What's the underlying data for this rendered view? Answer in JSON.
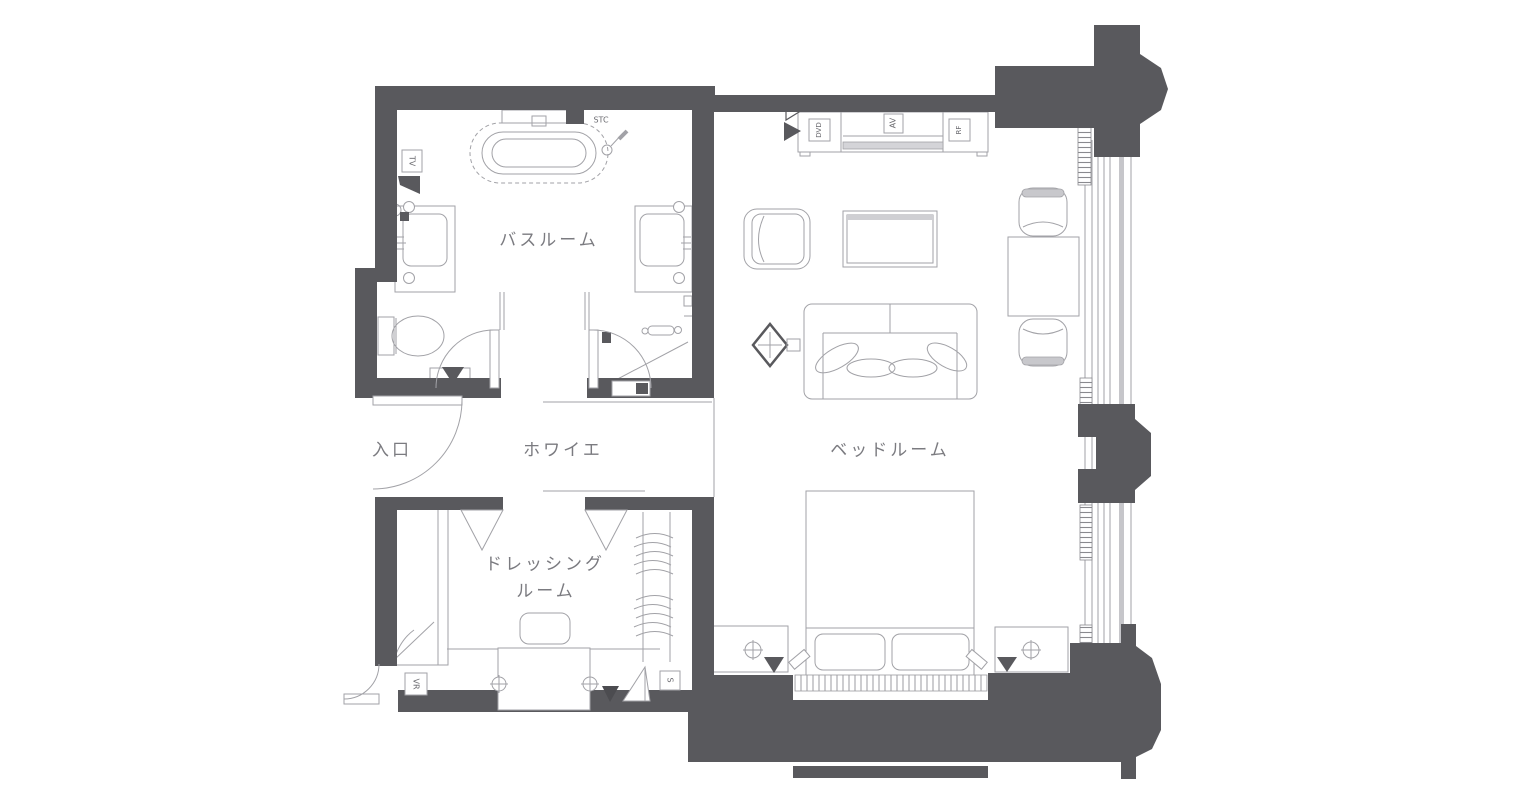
{
  "rooms": {
    "bathroom": {
      "label": "バスルーム"
    },
    "entrance": {
      "label": "入口"
    },
    "foyer": {
      "label": "ホワイエ"
    },
    "bedroom": {
      "label": "ベッドルーム"
    },
    "dressing": {
      "label_line1": "ドレッシング",
      "label_line2": "ルーム"
    }
  },
  "tags": {
    "tv": "TV",
    "stc": "STC",
    "dvd": "DVD",
    "av": "AV",
    "rf": "RF",
    "vr": "VR",
    "s": "S"
  },
  "colors": {
    "wall": "#59595d",
    "line": "#a2a2a7",
    "label_text": "#7b7b80",
    "tag_text": "#6b6b70",
    "background": "#ffffff"
  }
}
